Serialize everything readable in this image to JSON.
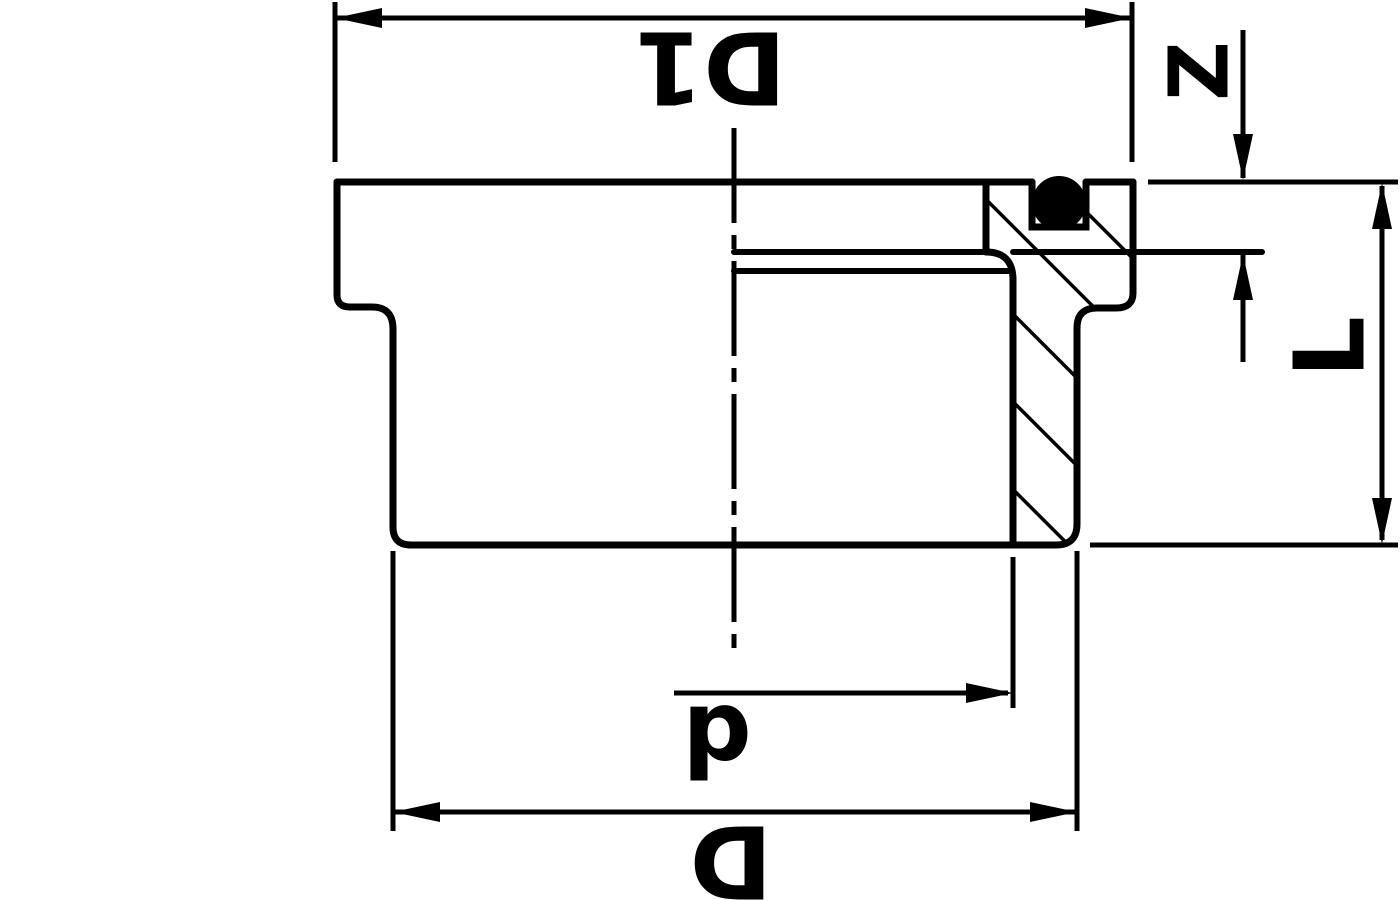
{
  "drawing": {
    "background_color": "#ffffff",
    "line_color": "#000000",
    "labels": {
      "d1": "D1",
      "z": "Z",
      "l": "L",
      "d_small": "d",
      "d_big": "D"
    }
  }
}
